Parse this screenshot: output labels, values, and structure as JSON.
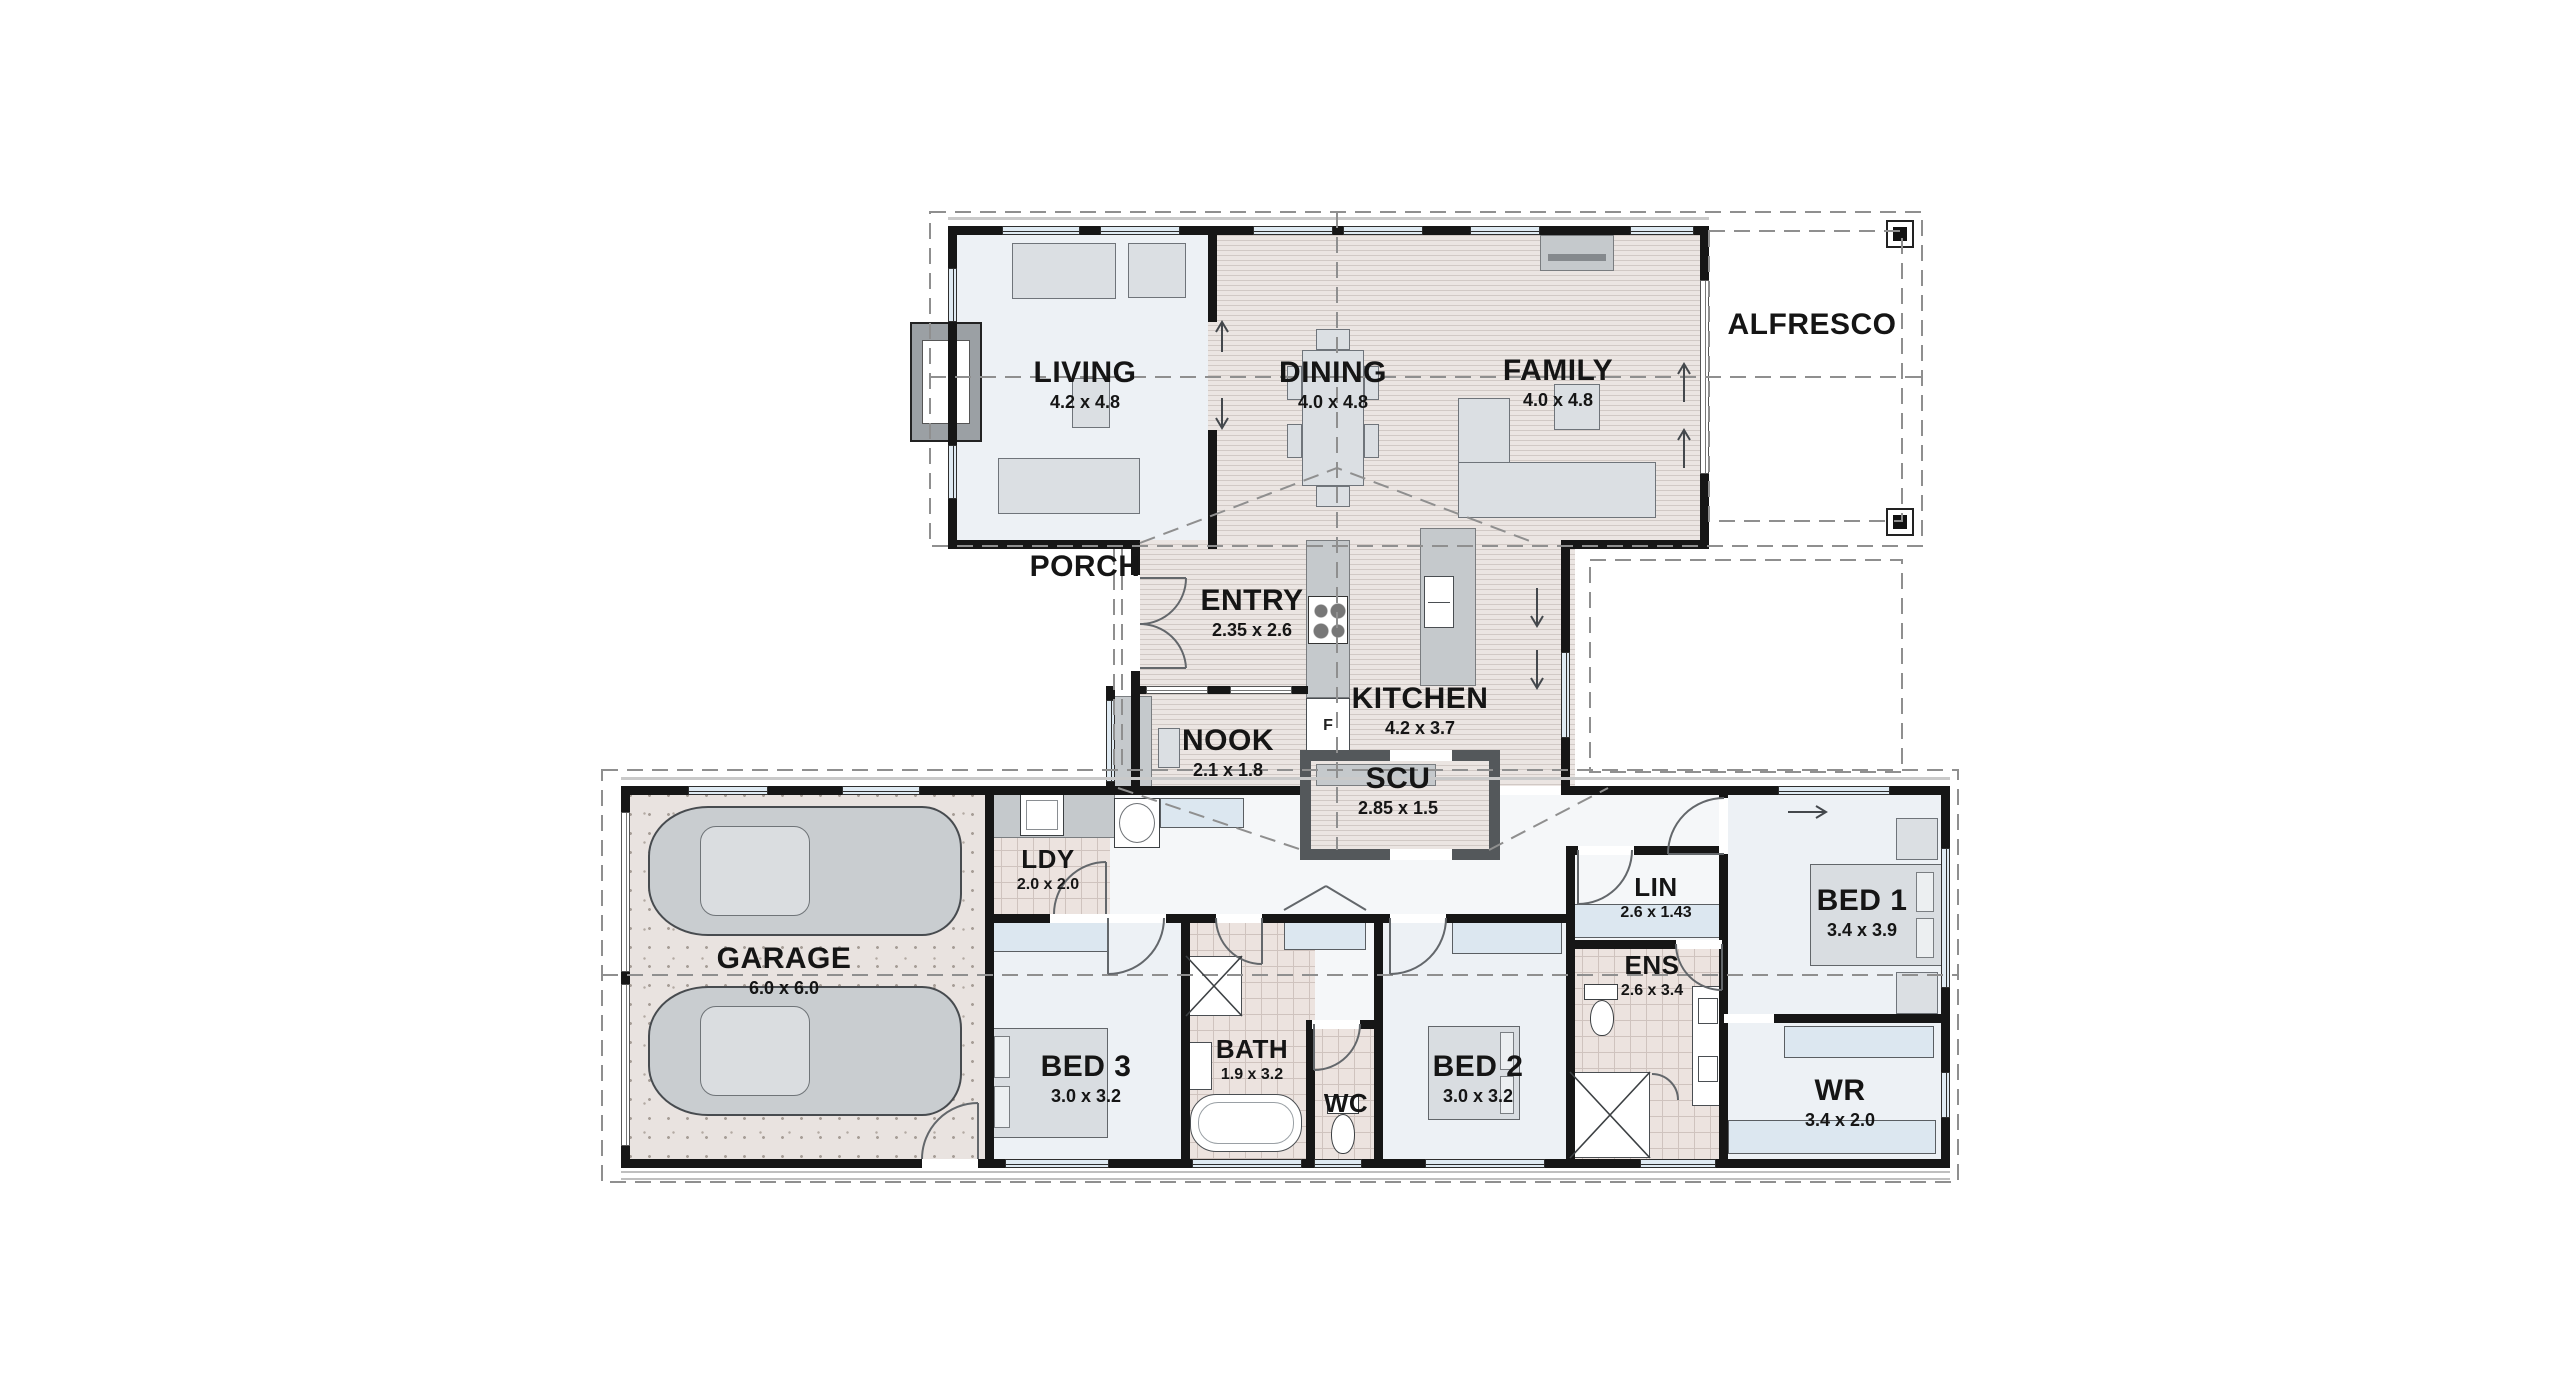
{
  "plan": {
    "type": "floor-plan",
    "rooms": [
      {
        "name": "LIVING",
        "dims": "4.2 x 4.8"
      },
      {
        "name": "DINING",
        "dims": "4.0 x 4.8"
      },
      {
        "name": "FAMILY",
        "dims": "4.0 x 4.8"
      },
      {
        "name": "ALFRESCO",
        "dims": ""
      },
      {
        "name": "PORCH",
        "dims": ""
      },
      {
        "name": "ENTRY",
        "dims": "2.35 x 2.6"
      },
      {
        "name": "KITCHEN",
        "dims": "4.2 x 3.7"
      },
      {
        "name": "NOOK",
        "dims": "2.1 x 1.8"
      },
      {
        "name": "SCU",
        "dims": "2.85 x 1.5"
      },
      {
        "name": "LDY",
        "dims": "2.0 x 2.0"
      },
      {
        "name": "GARAGE",
        "dims": "6.0 x 6.0"
      },
      {
        "name": "BED 3",
        "dims": "3.0 x 3.2"
      },
      {
        "name": "BATH",
        "dims": "1.9 x 3.2"
      },
      {
        "name": "WC",
        "dims": ""
      },
      {
        "name": "BED 2",
        "dims": "3.0 x 3.2"
      },
      {
        "name": "LIN",
        "dims": "2.6 x 1.43"
      },
      {
        "name": "ENS",
        "dims": "2.6 x 3.4"
      },
      {
        "name": "BED 1",
        "dims": "3.4 x 3.9"
      },
      {
        "name": "WR",
        "dims": "3.4 x 2.0"
      }
    ],
    "fixtures": {
      "fridge_label": "F"
    },
    "colors": {
      "wall": "#161616",
      "wood_floor": "#ebe5e2",
      "tile_floor": "#ece3df",
      "carpet_floor": "#edf1f5",
      "garage_floor": "#e9e3e0",
      "window": "#dfeaf2",
      "furniture": "#dbdfe3",
      "dashed_lines": "#8f8f8f"
    }
  }
}
